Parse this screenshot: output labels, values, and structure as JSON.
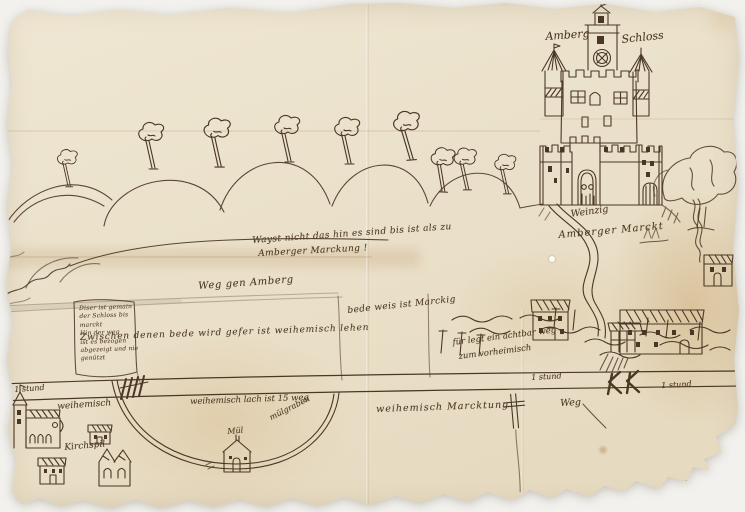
{
  "document": {
    "type": "hand-drawn historical manuscript map, ink on aged paper",
    "subject": "Amberg castle, river, mill and village boundaries"
  },
  "labels": {
    "castle_left": "Amberg",
    "castle_right": "Schloss",
    "center_note_line1": "Wayst nicht das hin es sind bis ist als zu",
    "center_note_line2": "Amberger Marckung !",
    "road_to_amberg": "Weg gen Amberg",
    "boundary_note": "Zwischen denen bede wird gefer ist weihemisch lehen",
    "meadow_note": "bede weis ist Marckig",
    "weir_note_line1": "für legt ein achtbar weg",
    "weir_note_line2": "zum vorheimisch",
    "riverbank_note_line1": "Weinzig",
    "riverbank_note_line2": "Amberger Marckt",
    "distance_markers": [
      "1 stund",
      "1 stund",
      "1 stund"
    ],
    "pond_note": "weihemisch lach ist 15 weg",
    "mill_stream": "mülgraben",
    "mill": "Mül",
    "village_1": "weihemisch",
    "village_2": "Kirchspil",
    "territory_note": "weihemisch Marcktung",
    "road_note": "Weg",
    "marginal_box_lines": [
      "Diser ist gemain",
      "der Schloss bis",
      "marckt",
      "Hin der weg",
      "ist es bezogen",
      "abgezeigt und nie",
      "genützt"
    ]
  },
  "colors": {
    "paper": "#e9dfc8",
    "stain": "#c89f66",
    "ink": "#4a3726",
    "background": "#f2f1ed"
  }
}
